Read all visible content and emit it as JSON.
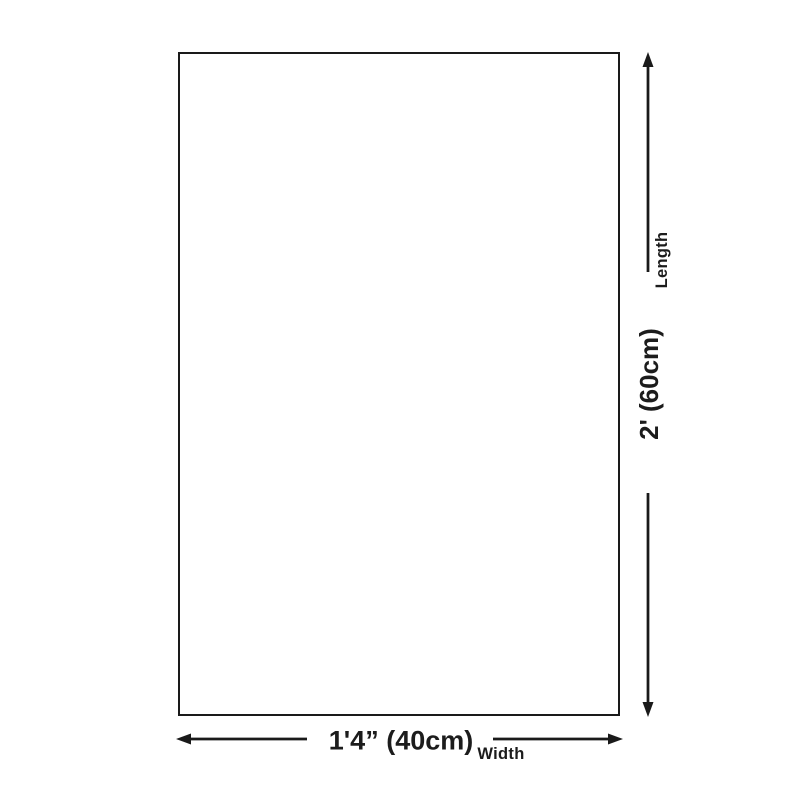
{
  "diagram": {
    "type": "product-dimensions",
    "shape": "rectangle",
    "length": {
      "label": "Length",
      "value": "2' (60cm)"
    },
    "width": {
      "label": "Width",
      "value": "1'4” (40cm)"
    }
  },
  "colors": {
    "background": "#ffffff",
    "line": "#1a1a1a",
    "text": "#1c1c1c"
  }
}
